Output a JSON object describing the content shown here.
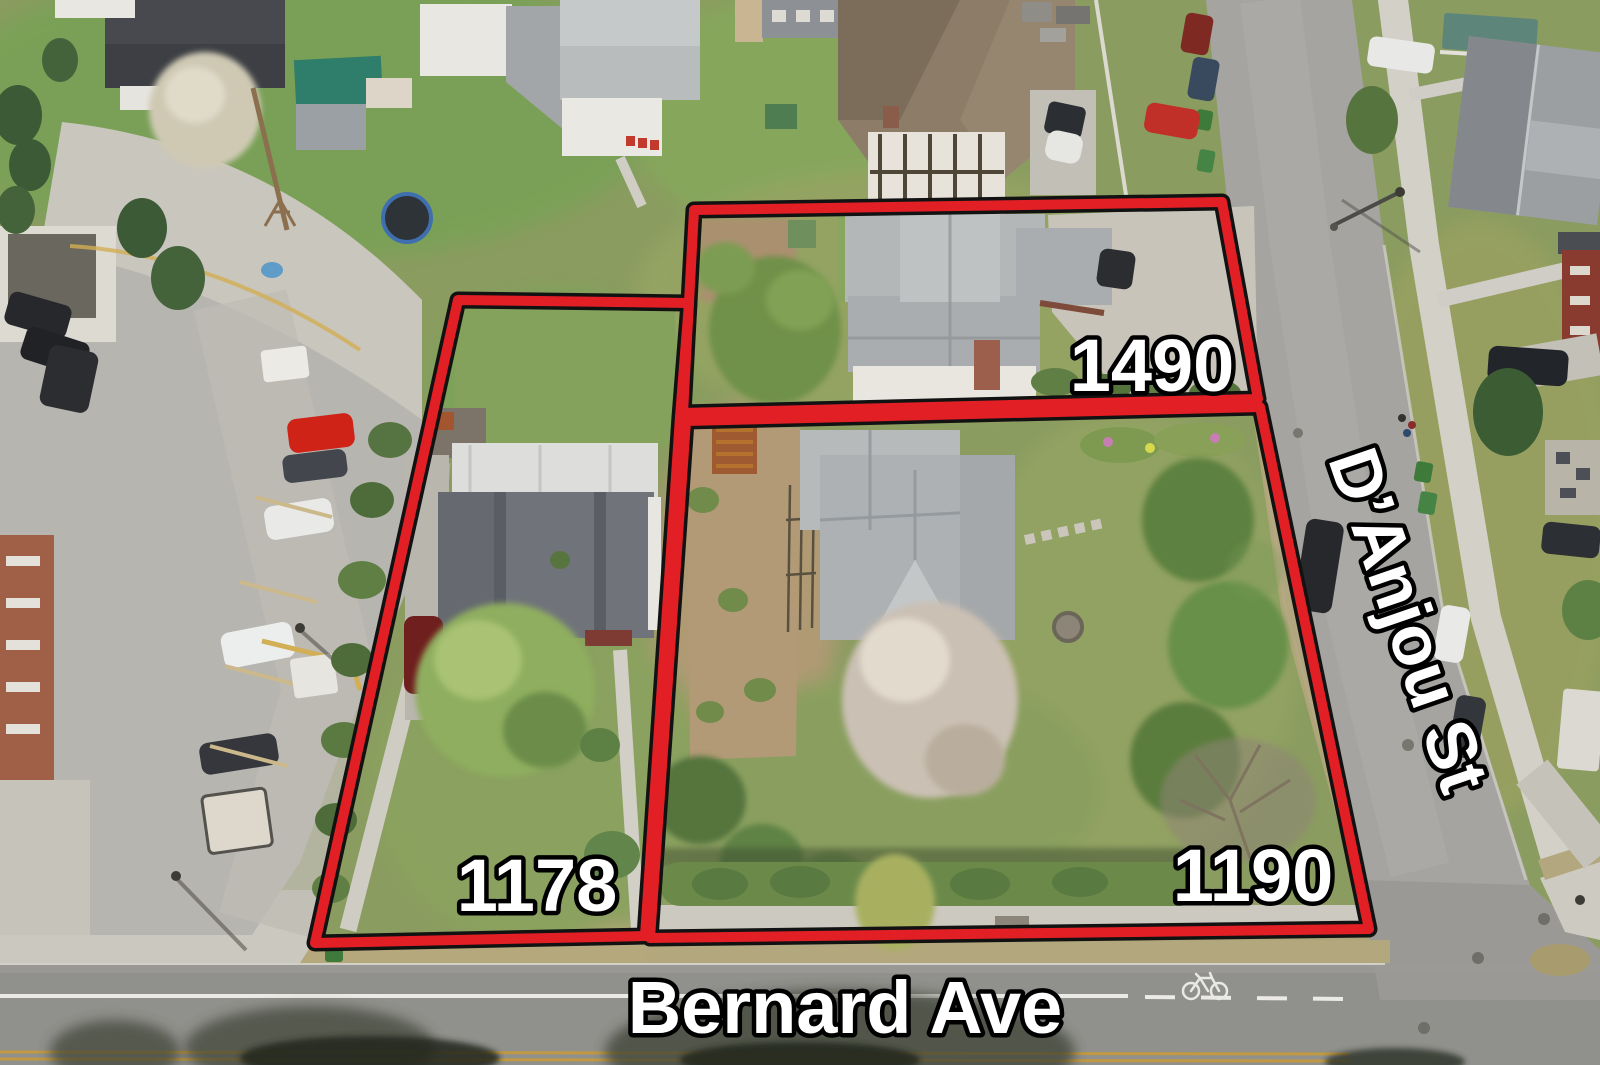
{
  "colors": {
    "boundary_red": "#e31f26",
    "label_fill": "#ffffff",
    "label_outline": "#000000"
  },
  "annotations": {
    "lots": [
      {
        "label": "1490"
      },
      {
        "label": "1178"
      },
      {
        "label": "1190"
      }
    ],
    "streets": [
      {
        "label": "D’Anjou St"
      },
      {
        "label": "Bernard Ave"
      }
    ]
  }
}
